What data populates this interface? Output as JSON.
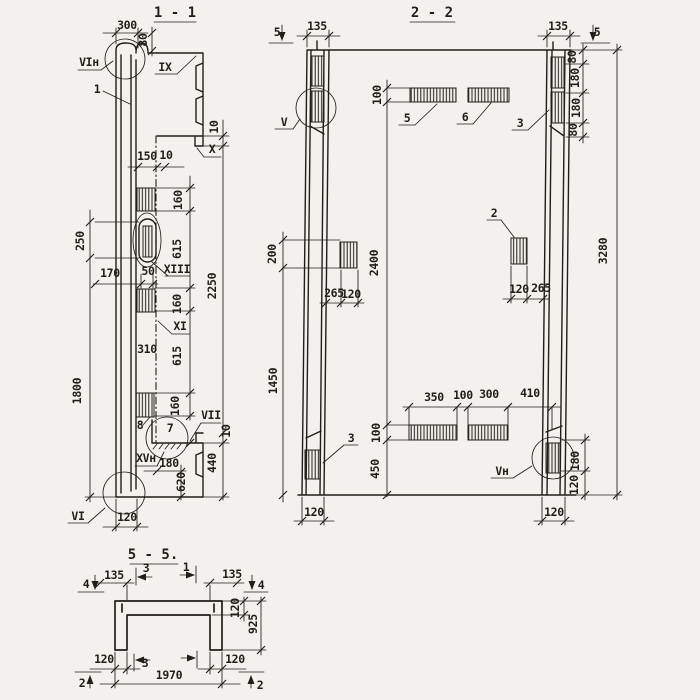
{
  "palette": {
    "paper": "#f2f1ed",
    "ink": "#211e1a"
  },
  "sections": {
    "s11": {
      "title": "1 - 1"
    },
    "s22": {
      "title": "2 - 2"
    },
    "s55": {
      "title": "5 - 5."
    }
  },
  "labels": [
    {
      "t": "300",
      "x": 127,
      "y": 29,
      "name": "dim-300-top"
    },
    {
      "t": "80",
      "x": 147,
      "y": 40,
      "r": -90,
      "name": "dim-80-top"
    },
    {
      "t": "VIн",
      "x": 89,
      "y": 66,
      "name": "detail-vi-n"
    },
    {
      "t": "1",
      "x": 97,
      "y": 93,
      "name": "item-1"
    },
    {
      "t": "IX",
      "x": 165,
      "y": 71,
      "name": "detail-ix"
    },
    {
      "t": "10",
      "x": 218,
      "y": 127,
      "r": -90,
      "name": "dim-10-upper"
    },
    {
      "t": "X",
      "x": 212,
      "y": 153,
      "name": "detail-x"
    },
    {
      "t": "150",
      "x": 147,
      "y": 160,
      "name": "dim-150"
    },
    {
      "t": "10",
      "x": 166,
      "y": 159,
      "name": "dim-10-wall"
    },
    {
      "t": "160",
      "x": 182,
      "y": 200,
      "r": -90,
      "name": "dim-160-a"
    },
    {
      "t": "250",
      "x": 84,
      "y": 241,
      "r": -90,
      "name": "dim-250"
    },
    {
      "t": "615",
      "x": 181,
      "y": 249,
      "r": -90,
      "name": "dim-615-a"
    },
    {
      "t": "XIII",
      "x": 177,
      "y": 273,
      "name": "detail-xiii"
    },
    {
      "t": "170",
      "x": 110,
      "y": 277,
      "name": "dim-170"
    },
    {
      "t": "50",
      "x": 148,
      "y": 275,
      "name": "dim-50"
    },
    {
      "t": "2250",
      "x": 216,
      "y": 286,
      "r": -90,
      "name": "dim-2250"
    },
    {
      "t": "160",
      "x": 181,
      "y": 304,
      "r": -90,
      "name": "dim-160-b"
    },
    {
      "t": "XI",
      "x": 180,
      "y": 330,
      "name": "detail-xi"
    },
    {
      "t": "310",
      "x": 147,
      "y": 353,
      "name": "dim-310"
    },
    {
      "t": "615",
      "x": 181,
      "y": 356,
      "r": -90,
      "name": "dim-615-b"
    },
    {
      "t": "1800",
      "x": 81,
      "y": 391,
      "r": -90,
      "name": "dim-1800"
    },
    {
      "t": "160",
      "x": 179,
      "y": 406,
      "r": -90,
      "name": "dim-160-c"
    },
    {
      "t": "8",
      "x": 140,
      "y": 429,
      "name": "item-8"
    },
    {
      "t": "7",
      "x": 170,
      "y": 432,
      "name": "item-7"
    },
    {
      "t": "VII",
      "x": 211,
      "y": 419,
      "name": "detail-vii"
    },
    {
      "t": "10",
      "x": 230,
      "y": 431,
      "r": -90,
      "name": "dim-10-lower"
    },
    {
      "t": "XVн",
      "x": 146,
      "y": 462,
      "name": "detail-xv-n"
    },
    {
      "t": "180",
      "x": 169,
      "y": 467,
      "name": "dim-180-step"
    },
    {
      "t": "440",
      "x": 216,
      "y": 463,
      "r": -90,
      "name": "dim-440"
    },
    {
      "t": "620",
      "x": 185,
      "y": 482,
      "r": -90,
      "name": "dim-620"
    },
    {
      "t": "VI",
      "x": 78,
      "y": 520,
      "name": "detail-vi"
    },
    {
      "t": "120",
      "x": 127,
      "y": 521,
      "name": "dim-120-wall-bottom"
    },
    {
      "t": "5",
      "x": 277,
      "y": 36,
      "name": "cut-5-left"
    },
    {
      "t": "135",
      "x": 317,
      "y": 30,
      "name": "dim-135-left-col"
    },
    {
      "t": "135",
      "x": 558,
      "y": 30,
      "name": "dim-135-right-col"
    },
    {
      "t": "5",
      "x": 597,
      "y": 36,
      "name": "cut-5-right"
    },
    {
      "t": "80",
      "x": 576,
      "y": 57,
      "r": -90,
      "name": "dim-80-r1"
    },
    {
      "t": "180",
      "x": 579,
      "y": 78,
      "r": -90,
      "name": "dim-180-r1"
    },
    {
      "t": "180",
      "x": 580,
      "y": 108,
      "r": -90,
      "name": "dim-180-r2"
    },
    {
      "t": "80",
      "x": 577,
      "y": 130,
      "r": -90,
      "name": "dim-80-r2"
    },
    {
      "t": "V",
      "x": 284,
      "y": 126,
      "name": "detail-v"
    },
    {
      "t": "100",
      "x": 381,
      "y": 95,
      "r": -90,
      "name": "dim-100-top"
    },
    {
      "t": "5",
      "x": 407,
      "y": 122,
      "name": "item-5"
    },
    {
      "t": "6",
      "x": 465,
      "y": 121,
      "name": "item-6"
    },
    {
      "t": "3",
      "x": 520,
      "y": 127,
      "name": "item-3-top"
    },
    {
      "t": "2",
      "x": 494,
      "y": 217,
      "name": "item-2"
    },
    {
      "t": "200",
      "x": 276,
      "y": 254,
      "r": -90,
      "name": "dim-200"
    },
    {
      "t": "2400",
      "x": 378,
      "y": 263,
      "r": -90,
      "name": "dim-2400"
    },
    {
      "t": "3280",
      "x": 607,
      "y": 251,
      "r": -90,
      "name": "dim-3280"
    },
    {
      "t": "265",
      "x": 334,
      "y": 297,
      "name": "dim-265-left"
    },
    {
      "t": "120",
      "x": 351,
      "y": 298,
      "name": "dim-120-left-mid"
    },
    {
      "t": "120",
      "x": 519,
      "y": 293,
      "name": "dim-120-right-mid"
    },
    {
      "t": "265",
      "x": 541,
      "y": 292,
      "name": "dim-265-right"
    },
    {
      "t": "1450",
      "x": 277,
      "y": 381,
      "r": -90,
      "name": "dim-1450"
    },
    {
      "t": "3",
      "x": 351,
      "y": 442,
      "name": "item-3-bottom"
    },
    {
      "t": "100",
      "x": 380,
      "y": 433,
      "r": -90,
      "name": "dim-100-bottom"
    },
    {
      "t": "450",
      "x": 379,
      "y": 469,
      "r": -90,
      "name": "dim-450"
    },
    {
      "t": "350",
      "x": 434,
      "y": 401,
      "name": "dim-350"
    },
    {
      "t": "100",
      "x": 463,
      "y": 399,
      "name": "dim-100-mid"
    },
    {
      "t": "300",
      "x": 489,
      "y": 398,
      "name": "dim-300-bottom"
    },
    {
      "t": "410",
      "x": 530,
      "y": 397,
      "name": "dim-410"
    },
    {
      "t": "Vн",
      "x": 502,
      "y": 475,
      "name": "detail-v-n"
    },
    {
      "t": "180",
      "x": 579,
      "y": 461,
      "r": -90,
      "name": "dim-180-br"
    },
    {
      "t": "120",
      "x": 578,
      "y": 485,
      "r": -90,
      "name": "dim-120-br"
    },
    {
      "t": "120",
      "x": 314,
      "y": 516,
      "name": "dim-120-col-left"
    },
    {
      "t": "120",
      "x": 554,
      "y": 516,
      "name": "dim-120-col-right"
    },
    {
      "t": "4",
      "x": 86,
      "y": 588,
      "name": "cut-4-left"
    },
    {
      "t": "135",
      "x": 114,
      "y": 579,
      "name": "dim-135-55-left"
    },
    {
      "t": "3",
      "x": 146,
      "y": 572,
      "name": "cut-3-top"
    },
    {
      "t": "1",
      "x": 186,
      "y": 571,
      "name": "cut-1-top"
    },
    {
      "t": "135",
      "x": 232,
      "y": 578,
      "name": "dim-135-55-right"
    },
    {
      "t": "4",
      "x": 261,
      "y": 589,
      "name": "cut-4-right"
    },
    {
      "t": "120",
      "x": 239,
      "y": 608,
      "r": -90,
      "name": "dim-120-flange"
    },
    {
      "t": "925",
      "x": 257,
      "y": 624,
      "r": -90,
      "name": "dim-925"
    },
    {
      "t": "120",
      "x": 104,
      "y": 663,
      "name": "dim-120-55-left"
    },
    {
      "t": "3",
      "x": 145,
      "y": 667,
      "name": "cut-3-bottom"
    },
    {
      "t": "120",
      "x": 235,
      "y": 663,
      "name": "dim-120-55-right"
    },
    {
      "t": "1970",
      "x": 169,
      "y": 679,
      "name": "dim-1970"
    },
    {
      "t": "2",
      "x": 82,
      "y": 687,
      "name": "cut-2-left"
    },
    {
      "t": "2",
      "x": 260,
      "y": 689,
      "name": "cut-2-right"
    }
  ]
}
